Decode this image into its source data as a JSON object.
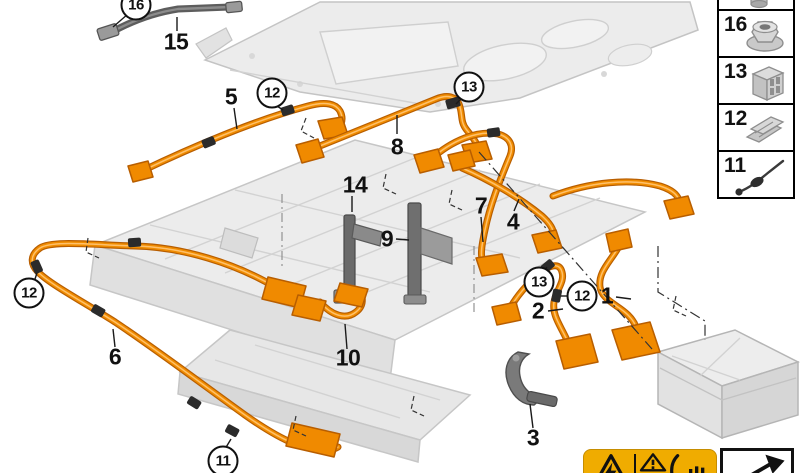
{
  "diagram": {
    "description": "High-voltage battery wiring harness exploded parts diagram",
    "callouts": [
      {
        "id": "16-top",
        "label": "16",
        "circled": true
      },
      {
        "id": "15",
        "label": "15",
        "circled": false
      },
      {
        "id": "5",
        "label": "5",
        "circled": false
      },
      {
        "id": "12-top",
        "label": "12",
        "circled": true
      },
      {
        "id": "8",
        "label": "8",
        "circled": false
      },
      {
        "id": "13-top",
        "label": "13",
        "circled": true
      },
      {
        "id": "14",
        "label": "14",
        "circled": false
      },
      {
        "id": "9",
        "label": "9",
        "circled": false
      },
      {
        "id": "7",
        "label": "7",
        "circled": false
      },
      {
        "id": "4",
        "label": "4",
        "circled": false
      },
      {
        "id": "12-left",
        "label": "12",
        "circled": true
      },
      {
        "id": "6",
        "label": "6",
        "circled": false
      },
      {
        "id": "10",
        "label": "10",
        "circled": false
      },
      {
        "id": "11",
        "label": "11",
        "circled": true
      },
      {
        "id": "13-right",
        "label": "13",
        "circled": true
      },
      {
        "id": "2",
        "label": "2",
        "circled": false
      },
      {
        "id": "12-right",
        "label": "12",
        "circled": true
      },
      {
        "id": "1",
        "label": "1",
        "circled": false
      },
      {
        "id": "3",
        "label": "3",
        "circled": false
      }
    ]
  },
  "legend": {
    "items": [
      {
        "label": "",
        "icon": "bushing-icon"
      },
      {
        "label": "16",
        "icon": "flange-nut-icon"
      },
      {
        "label": "13",
        "icon": "connector-housing-icon"
      },
      {
        "label": "12",
        "icon": "retaining-clip-icon"
      },
      {
        "label": "11",
        "icon": "bowden-cable-icon"
      }
    ]
  },
  "warning_panel": {
    "icons": [
      "high-voltage-warning-icon",
      "read-manual-warning-icon",
      "hand-wait-warning-icon"
    ]
  },
  "removal_panel": {
    "icons": [
      "removal-arrow-icon"
    ]
  },
  "colors": {
    "cable_orange": "#F08C00",
    "cable_outline": "#B85E00",
    "cable_highlight": "#FFC06A",
    "warning_yellow": "#F0AC00",
    "part_light_gray": "#ECECEC",
    "dark_part_gray": "#6A6A6A"
  }
}
